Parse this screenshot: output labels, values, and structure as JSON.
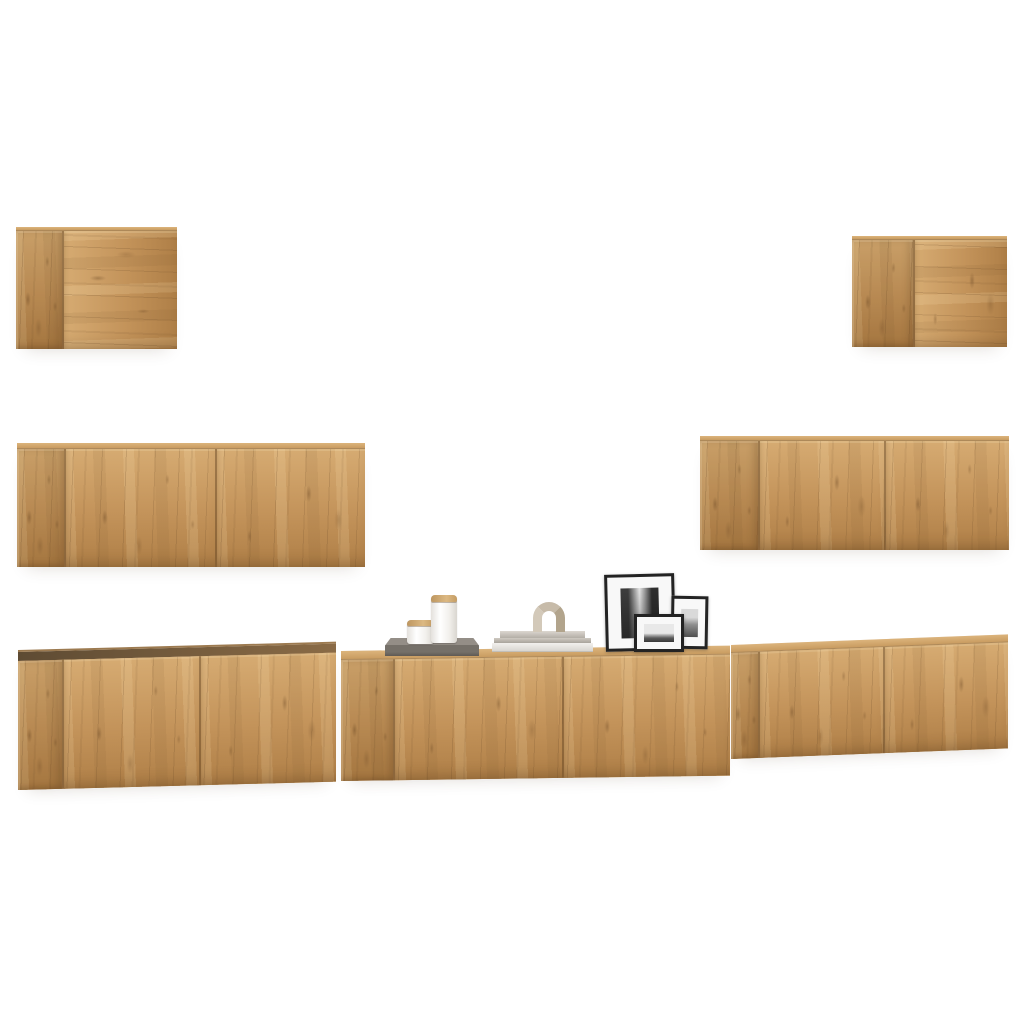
{
  "scene": {
    "kind": "product-photo",
    "subject": "7-piece wall-mounted TV cabinet set in artisan oak on a white background",
    "background": "#ffffff"
  },
  "palette": {
    "wood-hi": "#d6ab72",
    "wood-mid": "#c3935a",
    "wood-lo": "#af7f47",
    "wood-dark-edge": "#5e4b33",
    "wood-light-edge": "#dcb47c",
    "tray-gray": "#757069",
    "frame-black": "#232323",
    "mat-white": "#f8f8f8",
    "ceramic-white": "#f4f2ef",
    "decor-beige": "#c7bba9"
  },
  "cabinets": [
    {
      "name": "Small oak wall cabinet, top left",
      "doors": 1
    },
    {
      "name": "Small oak wall cabinet, top right",
      "doors": 1
    },
    {
      "name": "Oak wall TV cabinet, middle left",
      "doors": 2
    },
    {
      "name": "Oak wall TV cabinet, middle right",
      "doors": 2
    },
    {
      "name": "Oak wall TV cabinet, bottom left",
      "doors": 2
    },
    {
      "name": "Oak wall TV cabinet, bottom center with decor on top",
      "doors": 2
    },
    {
      "name": "Oak wall TV cabinet, bottom right",
      "doors": 2
    }
  ],
  "decor_items": [
    {
      "name": "Gray tray holding two white jars with wooden lids"
    },
    {
      "name": "White jar with wooden lid, small"
    },
    {
      "name": "White jar with wooden lid, tall"
    },
    {
      "name": "Stack of gray and white books"
    },
    {
      "name": "Beige arch sculpture"
    },
    {
      "name": "Large black picture frame with black-and-white city photo"
    },
    {
      "name": "Small black picture frame with black-and-white photo"
    },
    {
      "name": "Medium black picture frame with black-and-white skyline photo"
    }
  ]
}
